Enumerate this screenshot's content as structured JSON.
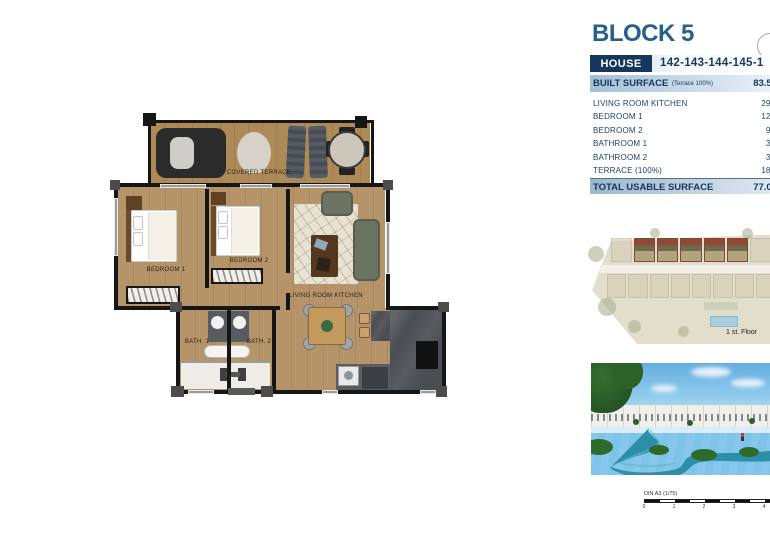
{
  "header": {
    "block_title": "BLOCK 5",
    "house_label": "HOUSE",
    "house_numbers": "142-143-144-145-1",
    "built_label": "BUILT SURFACE",
    "built_note": "(Terrace 100%)",
    "built_value": "83.50"
  },
  "table": {
    "rows": [
      {
        "label": "LIVING ROOM KITCHEN",
        "value": "29.5"
      },
      {
        "label": "BEDROOM 1",
        "value": "12.5"
      },
      {
        "label": "BEDROOM 2",
        "value": "9.7"
      },
      {
        "label": "BATHROOM 1",
        "value": "3.8"
      },
      {
        "label": "BATHROOM 2",
        "value": "3.5"
      },
      {
        "label": "TERRACE (100%)",
        "value": "18.0"
      }
    ],
    "total_label": "TOTAL USABLE SURFACE",
    "total_value": "77.00"
  },
  "plan": {
    "covered_terrace": "COVERED TERRACE",
    "bedroom1": "BEDROOM 1",
    "bedroom2": "BEDROOM 2",
    "living": "LIVING ROOM KITCHEN",
    "bath1": "BATH. 1",
    "bath2": "BATH. 2"
  },
  "site": {
    "floor_label": "1 st. Floor"
  },
  "scale": {
    "label": "DIN A3 (1/75)",
    "ticks": [
      "0",
      "1",
      "2",
      "3",
      "4"
    ]
  },
  "colors": {
    "navy": "#16375c",
    "title_blue": "#27608a",
    "header_gradient_start": "#a3c0d6",
    "header_gradient_end": "#eef4f9",
    "wood": "#b5946a",
    "wall": "#161616",
    "site_background": "#e3ddcc",
    "highlight_red": "#8f4934",
    "river": "#2e8ea8",
    "grass": "#69a84e",
    "sky": "#64aee0"
  }
}
